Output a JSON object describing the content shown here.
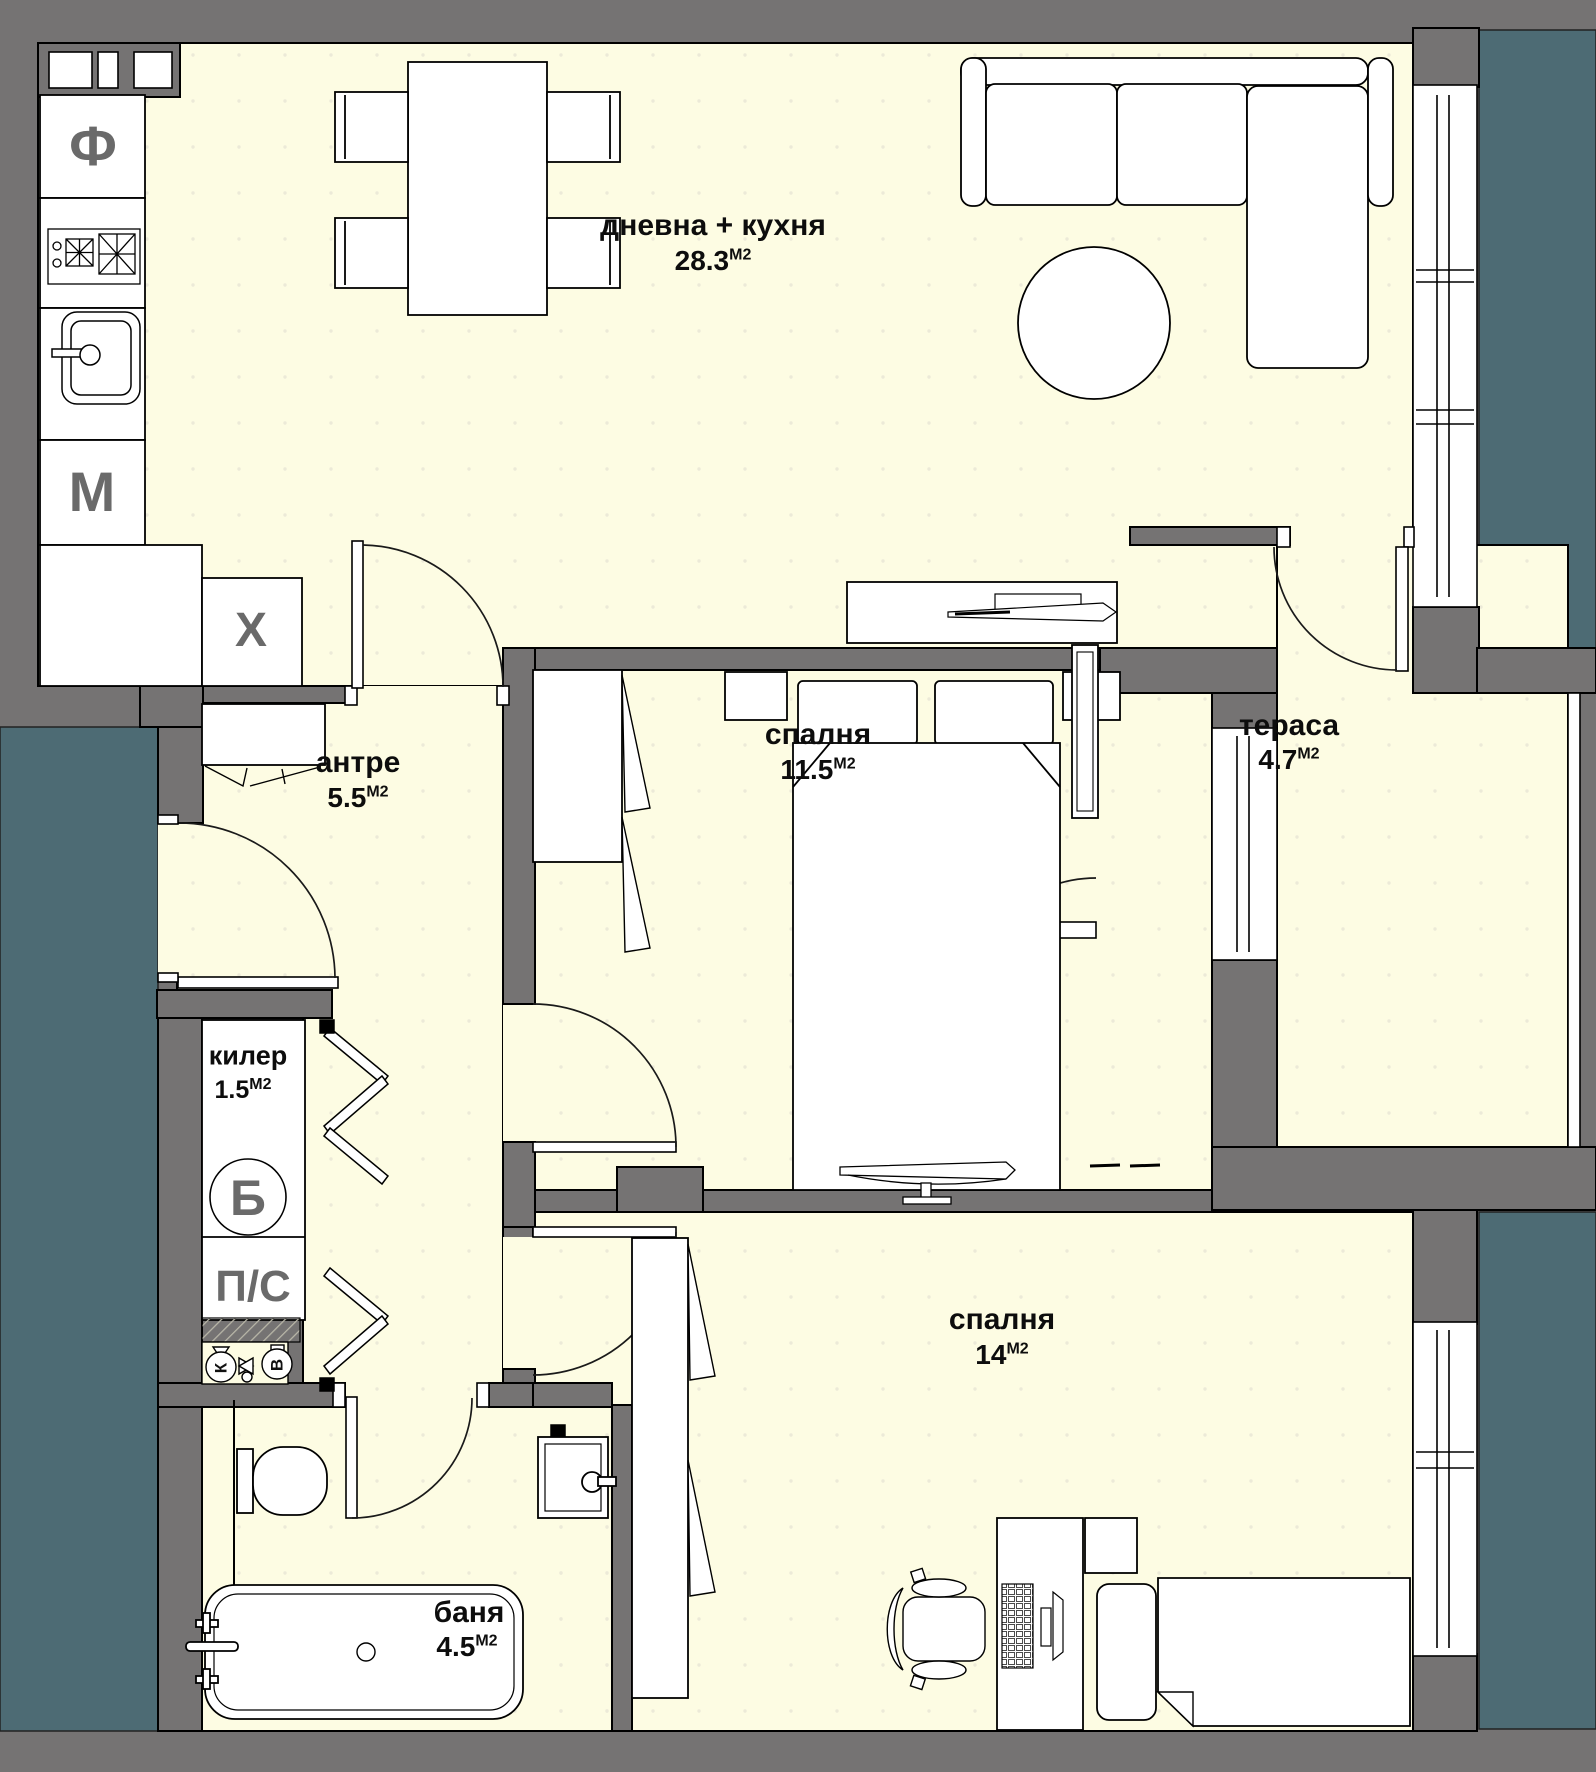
{
  "plan": {
    "type": "apartment-floor-plan",
    "language": "bg",
    "rooms": [
      {
        "id": "living-kitchen",
        "name": "дневна + кухня",
        "area": "28.3",
        "unit": "М2"
      },
      {
        "id": "bedroom-1",
        "name": "спалня",
        "area": "11.5",
        "unit": "М2"
      },
      {
        "id": "terrace",
        "name": "тераса",
        "area": "4.7",
        "unit": "М2"
      },
      {
        "id": "hallway",
        "name": "антре",
        "area": "5.5",
        "unit": "М2"
      },
      {
        "id": "closet",
        "name": "килер",
        "area": "1.5",
        "unit": "М2"
      },
      {
        "id": "bedroom-2",
        "name": "спалня",
        "area": "14",
        "unit": "М2"
      },
      {
        "id": "bathroom",
        "name": "баня",
        "area": "4.5",
        "unit": "М2"
      }
    ],
    "appliances": [
      {
        "id": "fridge",
        "label": "Ф"
      },
      {
        "id": "washing-machine",
        "label": "М"
      },
      {
        "id": "dishwasher",
        "label": "Х"
      },
      {
        "id": "boiler",
        "label": "Б"
      },
      {
        "id": "dryer",
        "label": "П/С"
      },
      {
        "id": "meter-cold",
        "label": "К"
      },
      {
        "id": "meter-hot",
        "label": "В"
      }
    ],
    "palette": {
      "wall": "#757373",
      "floor": "#FDFCE3",
      "outside": "#4D6B74",
      "furniture": "#FFFFFF",
      "line": "#000000",
      "letter": "#6a6a6a"
    }
  }
}
